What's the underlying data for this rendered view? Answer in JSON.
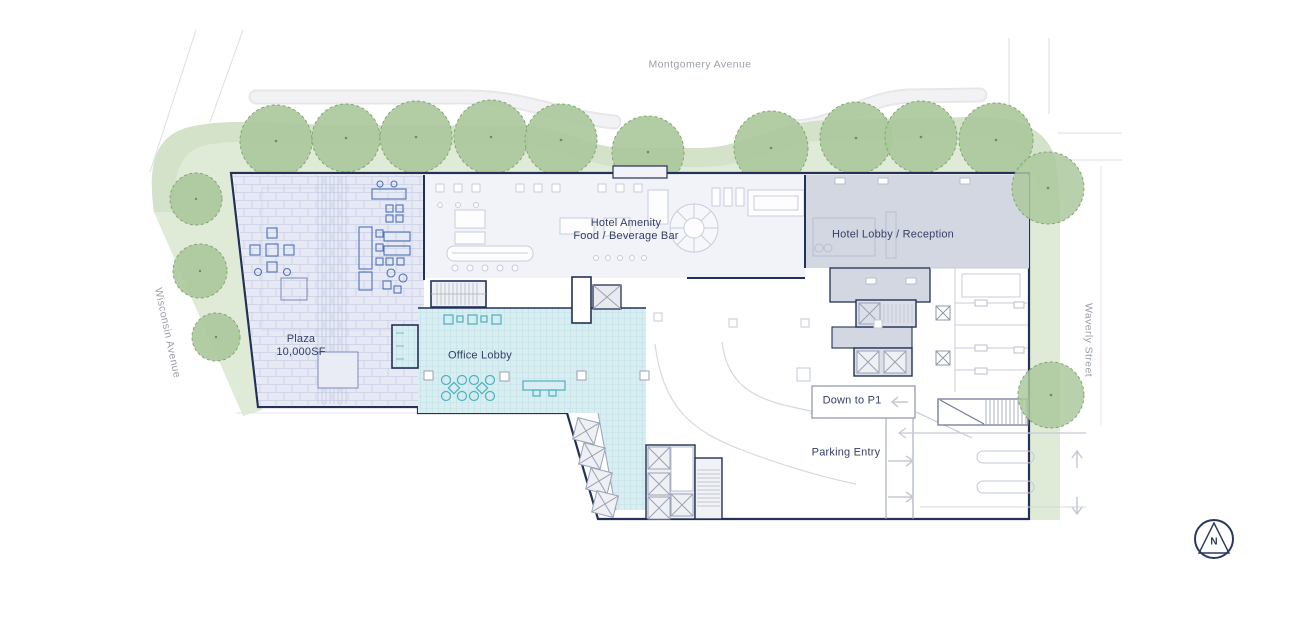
{
  "streets": {
    "top": "Montgomery Avenue",
    "left": "Wisconsin Avenue",
    "right": "Waverly Street"
  },
  "areas": {
    "plaza_line1": "Plaza",
    "plaza_line2": "10,000SF",
    "hotel_amenity_line1": "Hotel Amenity",
    "hotel_amenity_line2": "Food / Beverage Bar",
    "hotel_lobby": "Hotel Lobby / Reception",
    "office_lobby": "Office Lobby"
  },
  "parking": {
    "down_to_p1": "Down to P1",
    "parking_entry": "Parking Entry"
  },
  "compass": {
    "north": "N"
  },
  "colors": {
    "landscape_green": "#dfead7",
    "landscape_green_dark": "#cfe0c6",
    "tree_green": "#abc89c",
    "plaza_fill": "#e7e9f4",
    "office_lobby_teal": "#daeef1",
    "hotel_lobby_gray": "#d3d7e2",
    "building_outline": "#233158"
  }
}
